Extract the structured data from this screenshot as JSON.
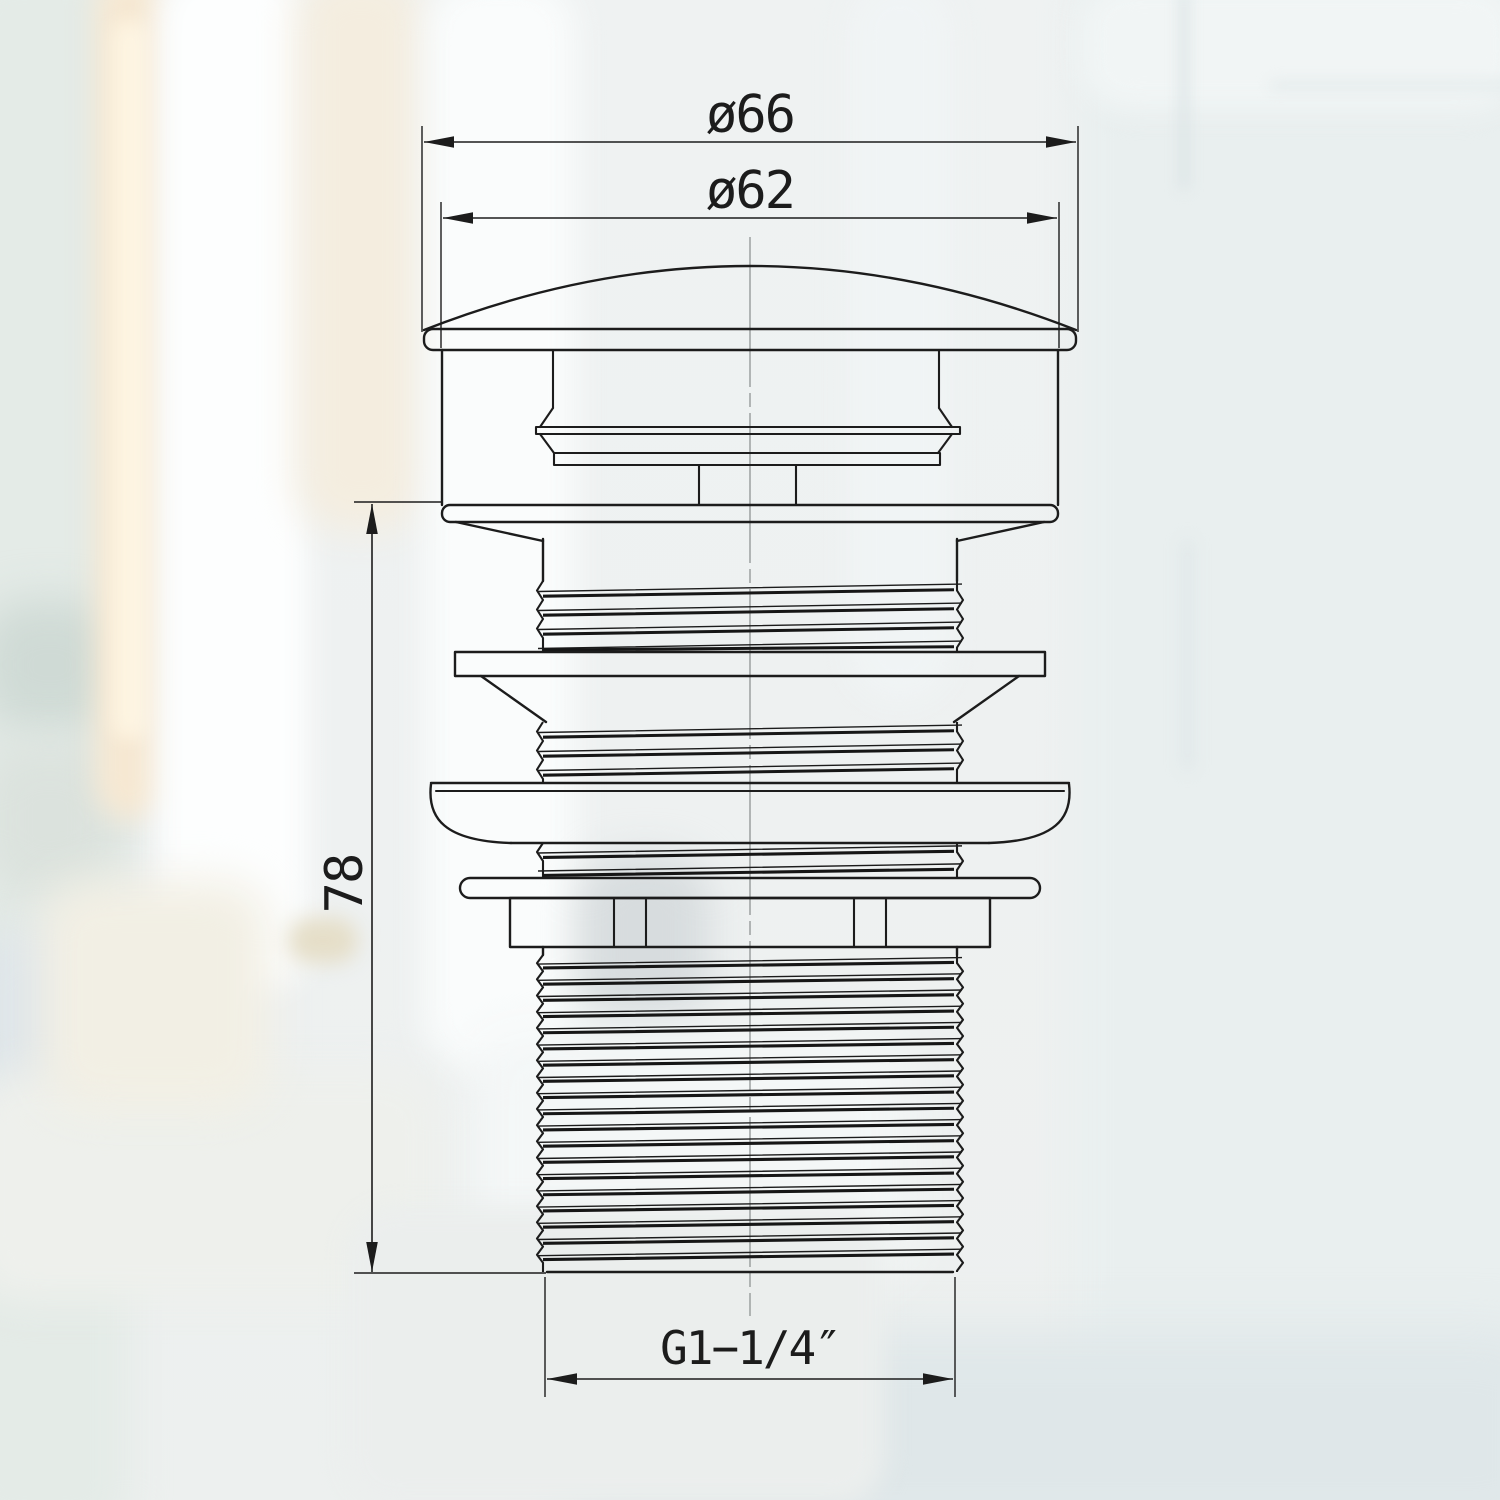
{
  "drawing": {
    "dimensions": {
      "outer_diameter": {
        "label": "ø66"
      },
      "cap_diameter": {
        "label": "ø62"
      },
      "body_height": {
        "label": "78"
      },
      "thread_size": {
        "label": "G1−1/4″"
      }
    },
    "colors": {
      "line": "#1c1c1c",
      "centerline": "#8f9494",
      "background": "#eef1f1"
    }
  }
}
